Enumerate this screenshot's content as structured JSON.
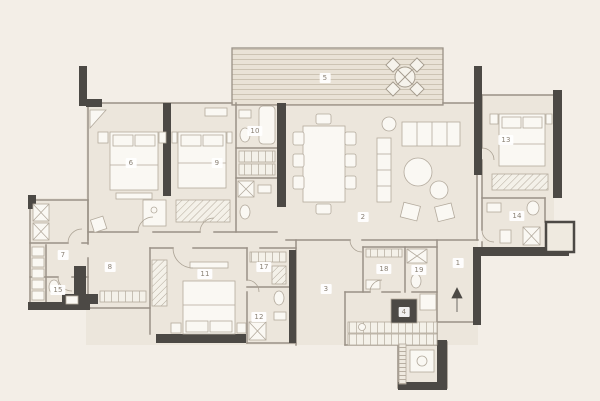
{
  "plan": {
    "kind": "apartment-floor-plan",
    "colors": {
      "background": "#f3eee7",
      "room_fill": "#ece6dc",
      "wall_dark": "#4c4945",
      "wall_line": "#9a9186",
      "furniture_fill": "#faf8f3",
      "label_text": "#8a8174",
      "label_bg": "#ffffff"
    }
  },
  "rooms": [
    {
      "num": "1",
      "name": "entry",
      "x": 458,
      "y": 263
    },
    {
      "num": "2",
      "name": "living-dining",
      "x": 363,
      "y": 217
    },
    {
      "num": "3",
      "name": "hallway",
      "x": 326,
      "y": 289
    },
    {
      "num": "4",
      "name": "kitchen",
      "x": 404,
      "y": 312
    },
    {
      "num": "5",
      "name": "terrace",
      "x": 325,
      "y": 78
    },
    {
      "num": "6",
      "name": "bedroom-1",
      "x": 131,
      "y": 163
    },
    {
      "num": "7",
      "name": "storage",
      "x": 63,
      "y": 255
    },
    {
      "num": "8",
      "name": "corridor",
      "x": 110,
      "y": 267
    },
    {
      "num": "9",
      "name": "bedroom-2",
      "x": 217,
      "y": 163
    },
    {
      "num": "10",
      "name": "bathroom-1",
      "x": 255,
      "y": 131
    },
    {
      "num": "11",
      "name": "master-bedroom",
      "x": 205,
      "y": 274
    },
    {
      "num": "12",
      "name": "master-bathroom",
      "x": 259,
      "y": 317
    },
    {
      "num": "13",
      "name": "bedroom-3",
      "x": 506,
      "y": 140
    },
    {
      "num": "14",
      "name": "ensuite-bathroom",
      "x": 517,
      "y": 216
    },
    {
      "num": "15",
      "name": "powder-room",
      "x": 58,
      "y": 290
    },
    {
      "num": "17",
      "name": "walk-in-closet",
      "x": 264,
      "y": 267
    },
    {
      "num": "18",
      "name": "utility-room",
      "x": 384,
      "y": 269
    },
    {
      "num": "19",
      "name": "guest-bathroom",
      "x": 419,
      "y": 270
    }
  ],
  "furniture_icons": [
    "double-bed-icon",
    "dining-table-icon",
    "sofa-icon",
    "armchair-icon",
    "round-terrace-table-icon",
    "wardrobe-icon",
    "toilet-icon",
    "sink-icon",
    "shower-icon",
    "bathtub-icon",
    "washing-machine-icon",
    "cooktop-icon",
    "entry-arrow-icon",
    "plant-icon"
  ]
}
